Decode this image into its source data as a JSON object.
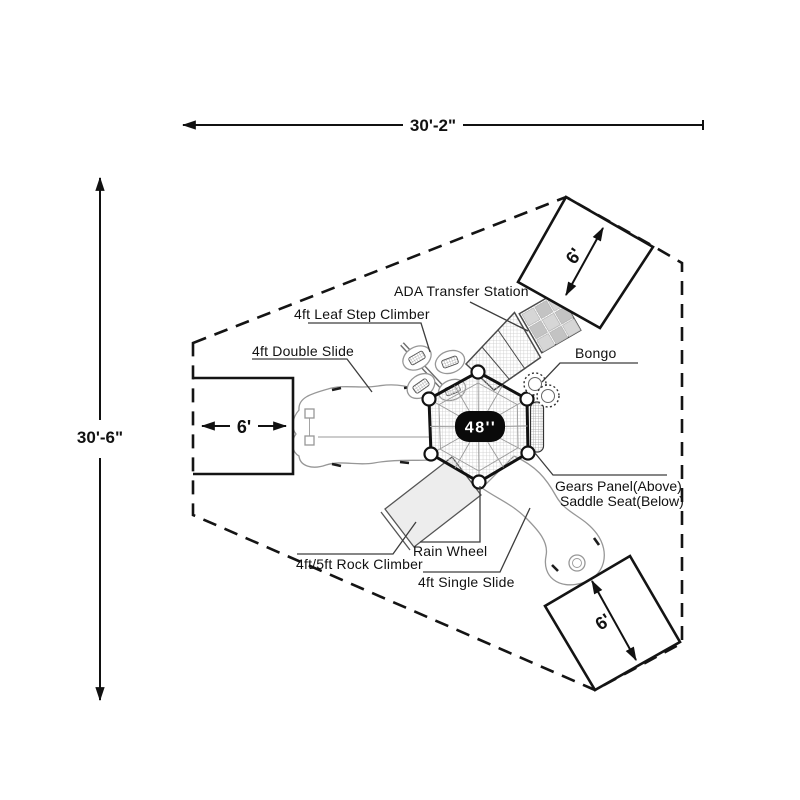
{
  "dimensions": {
    "overall_width": "30'-2\"",
    "overall_height": "30'-6\"",
    "deck_size": "48''",
    "clear_zone_left": "6'",
    "clear_zone_top_right": "6'",
    "clear_zone_bottom_right": "6'"
  },
  "components": {
    "ada_transfer_station": "ADA Transfer Station",
    "leaf_step_climber": "4ft Leaf Step Climber",
    "double_slide": "4ft Double Slide",
    "bongo": "Bongo",
    "gears_panel": "Gears Panel(Above)",
    "saddle_seat": "Saddle Seat(Below)",
    "rain_wheel": "Rain Wheel",
    "rock_climber": "4ft/5ft Rock Climber",
    "single_slide": "4ft Single Slide"
  },
  "colors": {
    "line": "#141414",
    "equipment_gray": "#979797",
    "hatch": "#c9c9c9",
    "badge_bg": "#0a0a0a",
    "badge_text": "#ffffff"
  }
}
